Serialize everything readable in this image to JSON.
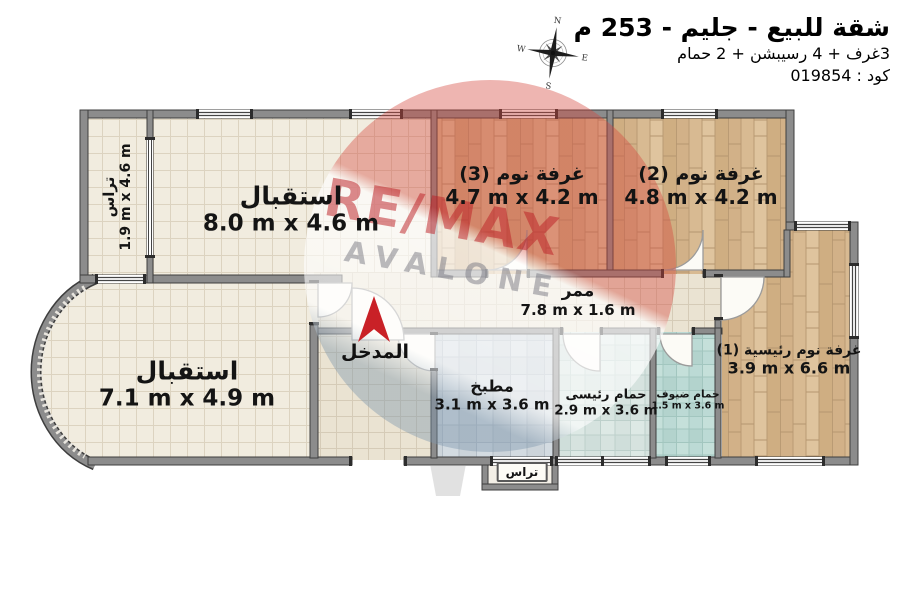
{
  "header": {
    "title": "شقة للبيع - جليم - 253 م",
    "subtitle": "3غرف + 4 رسيبشن + 2 حمام",
    "code": "كود : 019854"
  },
  "compass": {
    "north": "N",
    "east": "E",
    "south": "S",
    "west": "W"
  },
  "watermark": {
    "brand": "RE/MAX",
    "office": "AVALONE"
  },
  "rooms": {
    "terrace_left": {
      "name": "تراس",
      "dims": "1.9 m x 4.6 m"
    },
    "reception_top": {
      "name": "استقبال",
      "dims": "8.0 m x 4.6 m"
    },
    "bedroom3": {
      "name": "غرفة نوم (3)",
      "dims": "4.7 m x 4.2 m"
    },
    "bedroom2": {
      "name": "غرفة نوم (2)",
      "dims": "4.8 m x 4.2 m"
    },
    "corridor": {
      "name": "ممر",
      "dims": "7.8 m x 1.6 m"
    },
    "master_bedroom": {
      "name": "غرفة نوم رئيسية (1)",
      "dims": "3.9 m x 6.6 m"
    },
    "reception_bottom": {
      "name": "استقبال",
      "dims": "7.1 m x 4.9 m"
    },
    "kitchen": {
      "name": "مطبخ",
      "dims": "3.1 m x 3.6 m"
    },
    "bath_main": {
      "name": "حمام رئيسى",
      "dims": "2.9 m x 3.6 m"
    },
    "bath_guest": {
      "name": "حمام ضيوف",
      "dims": "1.5 m x 3.6 m"
    },
    "entrance": {
      "name": "المدخل"
    },
    "terrace_bottom": {
      "name": "تراس"
    }
  },
  "colors": {
    "wall": "#8c8c8c",
    "wood_floor": "#d8ba92",
    "tile_cream": "#f1ecdf",
    "tile_kitchen": "#ccd4da",
    "tile_bath_main": "#d6e3e0",
    "tile_bath_guest": "#bcdad5",
    "entrance_arrow": "#c92127",
    "watermark_red": "#bc2026",
    "watermark_gray": "#7d7d82"
  }
}
